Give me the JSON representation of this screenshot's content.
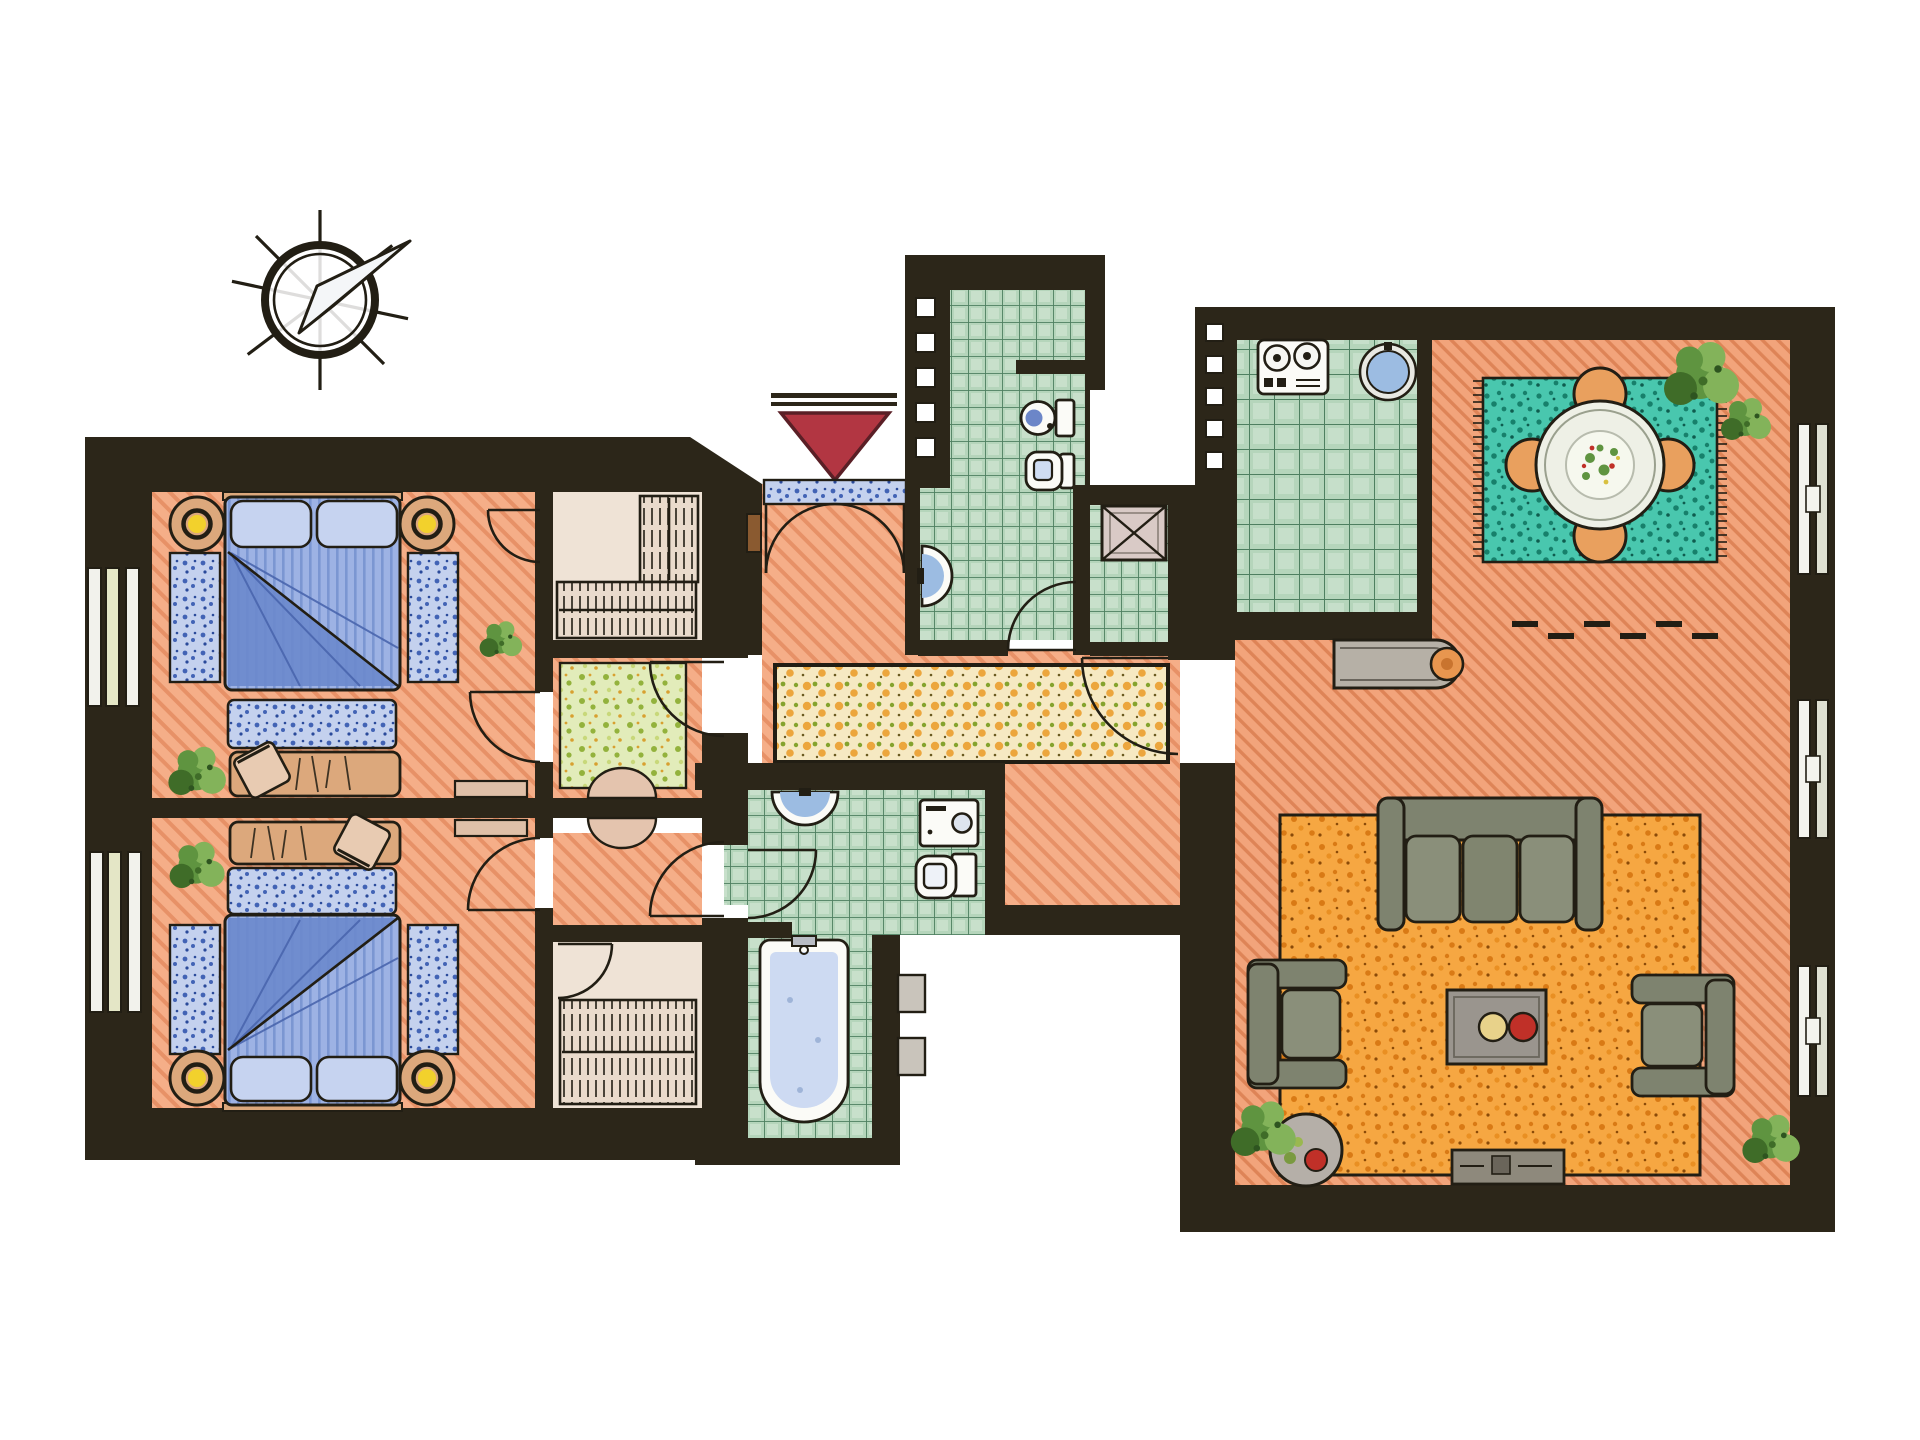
{
  "title": "Hand-drawn apartment floor plan, top view, with compass rose and entrance marker",
  "palette": {
    "wall": "#2c2619",
    "ink": "#221e14",
    "salmon": "#f5ae88",
    "salmon-line": "#e2875c",
    "living-floor": "#f2a47b",
    "living-line": "#d97c4e",
    "tile": "#b5d5bb",
    "tile-line": "#4e7f60",
    "tile-hi": "#d7e9d9",
    "teal-rug": "#49c7ae",
    "teal-dot": "#17806b",
    "orange-rug": "#f6a742",
    "orange-dot": "#d97a15",
    "runner": "#f6e9c2",
    "runner-orange": "#eca63d",
    "runner-green": "#85a32e",
    "lgreen-rug": "#e2ecba",
    "lgreen-dot": "#93b23c",
    "blue-rug": "#c4d1ee",
    "blue-dot": "#4263b5",
    "bed-blue": "#9db2e4",
    "bed-stripe": "#7b96d2",
    "bed-fold": "#6b88cc",
    "pillow": "#c6d3f0",
    "furniture-gray": "#7e836f",
    "cushion-gray": "#8a8f7a",
    "tan": "#dca87c",
    "ward": "#eadbcc",
    "lamp-yellow": "#f2d12c",
    "accent-red": "#b23642",
    "chair-orange": "#e9a05e",
    "white-fix": "#fbfbf7",
    "fix-blue": "#9cbce2",
    "plant": "#5f9440",
    "plant-dark": "#3f6c28",
    "plant-lite": "#83b35a",
    "shaft": "#d9cac6",
    "metal": "#c9c4bb"
  },
  "compass": {
    "symbol": "compass-rose",
    "needle_direction": "north-east",
    "spokes": 8
  },
  "entrance": {
    "symbol": "red-triangle-marker",
    "points": "down",
    "doormat": "blue threshold mat",
    "door": "double swing door"
  },
  "rooms": [
    {
      "id": "bedroom-1",
      "name": "Bedroom 1 (top left)",
      "floor": "salmon hatch",
      "furniture": [
        "double bed with blue duvet",
        "two pillows",
        "round nightstand with yellow lamp (left)",
        "round nightstand with yellow lamp (right)",
        "blue bedside runner rug (left)",
        "blue bedside runner rug (right)",
        "blue bench rug at bed foot",
        "desk with sketched papers",
        "desk chair",
        "corner plant"
      ]
    },
    {
      "id": "bedroom-2",
      "name": "Bedroom 2 (bottom left)",
      "floor": "salmon hatch",
      "furniture": [
        "double bed with blue duvet",
        "two pillows",
        "round nightstand with yellow lamp (left)",
        "round nightstand with yellow lamp (right)",
        "blue bedside runner rug (left)",
        "blue bedside runner rug (right)",
        "blue bench rug at bed foot",
        "desk with sketched papers",
        "desk chair",
        "corner plant"
      ]
    },
    {
      "id": "closet-1",
      "name": "Walk-in closet (top)",
      "floor": "pale",
      "furniture": [
        "wardrobe with hanging clothes",
        "wardrobe rail"
      ]
    },
    {
      "id": "closet-2",
      "name": "Walk-in closet (bottom)",
      "floor": "pale",
      "furniture": [
        "wardrobe with hanging clothes",
        "wardrobe rail"
      ]
    },
    {
      "id": "anteroom-1",
      "name": "Anteroom (top suite)",
      "floor": "salmon",
      "furniture": [
        "light green speckled rug",
        "console table",
        "half-round wall table"
      ]
    },
    {
      "id": "anteroom-2",
      "name": "Anteroom (bottom suite)",
      "floor": "salmon",
      "furniture": [
        "console table",
        "half-round wall table"
      ]
    },
    {
      "id": "entry-hall",
      "name": "Entry hall",
      "floor": "salmon",
      "furniture": [
        "blue doormat",
        "intercom panel"
      ]
    },
    {
      "id": "hallway",
      "name": "Hallway",
      "floor": "salmon",
      "furniture": [
        "long cream runner rug with orange and green speckles"
      ]
    },
    {
      "id": "bathroom-top",
      "name": "Bathroom (top, green tiled)",
      "floor": "green tiles",
      "furniture": [
        "toilet",
        "bidet",
        "semicircular washbasin",
        "shower partition",
        "glass block wall"
      ]
    },
    {
      "id": "shaft-room",
      "name": "Shaft / light well closet",
      "floor": "green tiles",
      "furniture": [
        "crossed shaft box"
      ]
    },
    {
      "id": "bathroom-lower",
      "name": "Bathroom (lower, green tiled)",
      "floor": "green tiles",
      "furniture": [
        "pedestal washbasin",
        "washing machine",
        "toilet"
      ]
    },
    {
      "id": "bathtub-room",
      "name": "Bathtub room",
      "floor": "green tiles",
      "furniture": [
        "bathtub with faucet",
        "two exterior ledge boxes"
      ]
    },
    {
      "id": "kitchen",
      "name": "Kitchen (green tiled)",
      "floor": "green tiles large grid",
      "furniture": [
        "stove with two burners and knobs",
        "round blue sink",
        "glass block wall"
      ]
    },
    {
      "id": "dining-area",
      "name": "Dining area",
      "floor": "salmon hatch",
      "furniture": [
        "teal fringed rug",
        "round dining table with salad platter",
        "four orange chairs",
        "corner plant",
        "sideboard console with orange lamp",
        "threshold step dashes"
      ]
    },
    {
      "id": "living-room",
      "name": "Living room",
      "floor": "salmon hatch",
      "furniture": [
        "large orange speckled rug",
        "three-seat gray sofa",
        "armchair (left)",
        "armchair (right)",
        "coffee table with yellow and red bowls",
        "round side table with red bowl",
        "media console",
        "corner plants"
      ]
    }
  ],
  "exterior": {
    "radiators_left_wall": 2,
    "radiators_right_wall": 3,
    "window_bars": "white parallel bars on outer walls"
  }
}
